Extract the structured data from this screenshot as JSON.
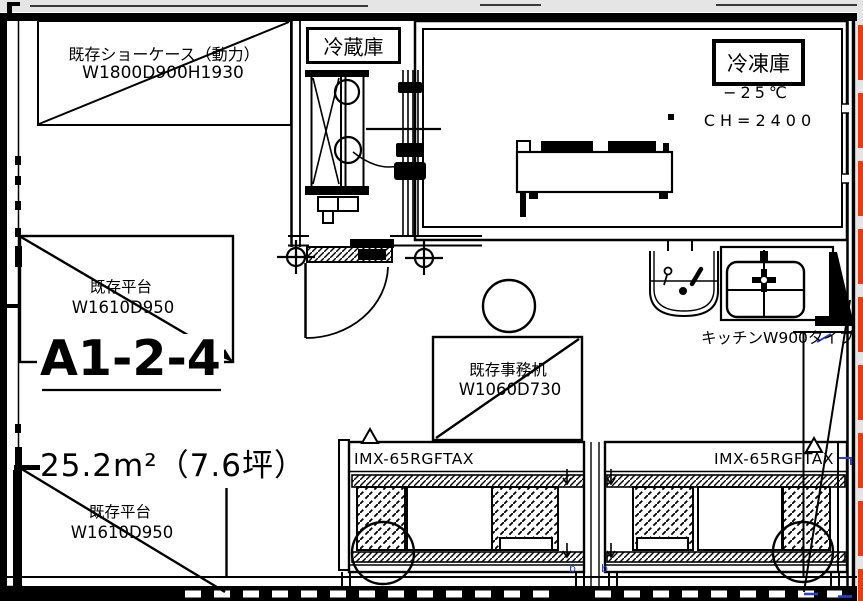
{
  "drawing": {
    "room_id": "A1-2-4",
    "area": "25.2m²（7.6坪）",
    "showcase": {
      "name": "既存ショーケース（動力）",
      "size": "W1800D900H1930"
    },
    "refrigerator": {
      "name": "冷蔵庫"
    },
    "freezer": {
      "name": "冷凍庫",
      "temperature": "−25℃",
      "ceiling_height": "CH=2400"
    },
    "platform_upper": {
      "name": "既存平台",
      "size": "W1610D950"
    },
    "platform_lower": {
      "name": "既存平台",
      "size": "W1610D950"
    },
    "desk": {
      "name": "既存事務机",
      "size": "W1060D730"
    },
    "kitchen": {
      "name": "キッチンW900タイプ"
    },
    "counter_left": {
      "model": "IMX-65RGFTAX"
    },
    "counter_right": {
      "model": "IMX-65RGFTAX"
    },
    "post_marks": {
      "left": "b",
      "right": "b"
    }
  },
  "colors": {
    "line": "#000000",
    "highlight_red": "#ee3a10",
    "mark_blue": "#2b3fd9",
    "strip_gray": "#e5e5e5",
    "corner_gray": "#c4c4c4"
  }
}
